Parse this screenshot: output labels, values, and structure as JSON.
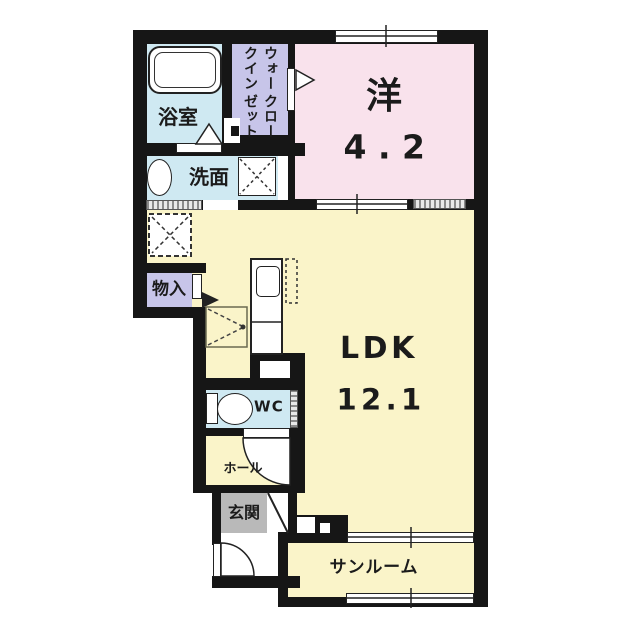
{
  "plan_type": "apartment-floor-plan",
  "colors": {
    "wall": "#161616",
    "water": "#cfe9f2",
    "closet": "#c7c5e9",
    "bedroom": "#f9e2ec",
    "living": "#faf4c9",
    "entrance": "#b9b9b9"
  },
  "rooms": {
    "bathroom": {
      "label": "浴室"
    },
    "walk_in_closet": {
      "label_line1": "ウォークイン",
      "label_line2": "クローゼット"
    },
    "western_room": {
      "label": "洋",
      "size": "4.2"
    },
    "washroom": {
      "label": "洗面"
    },
    "storage": {
      "label": "物入"
    },
    "ldk": {
      "label": "LDK",
      "size": "12.1"
    },
    "toilet": {
      "label": "WC"
    },
    "hall": {
      "label": "ホール"
    },
    "entrance": {
      "label": "玄関"
    },
    "sunroom": {
      "label": "サンルーム"
    }
  }
}
